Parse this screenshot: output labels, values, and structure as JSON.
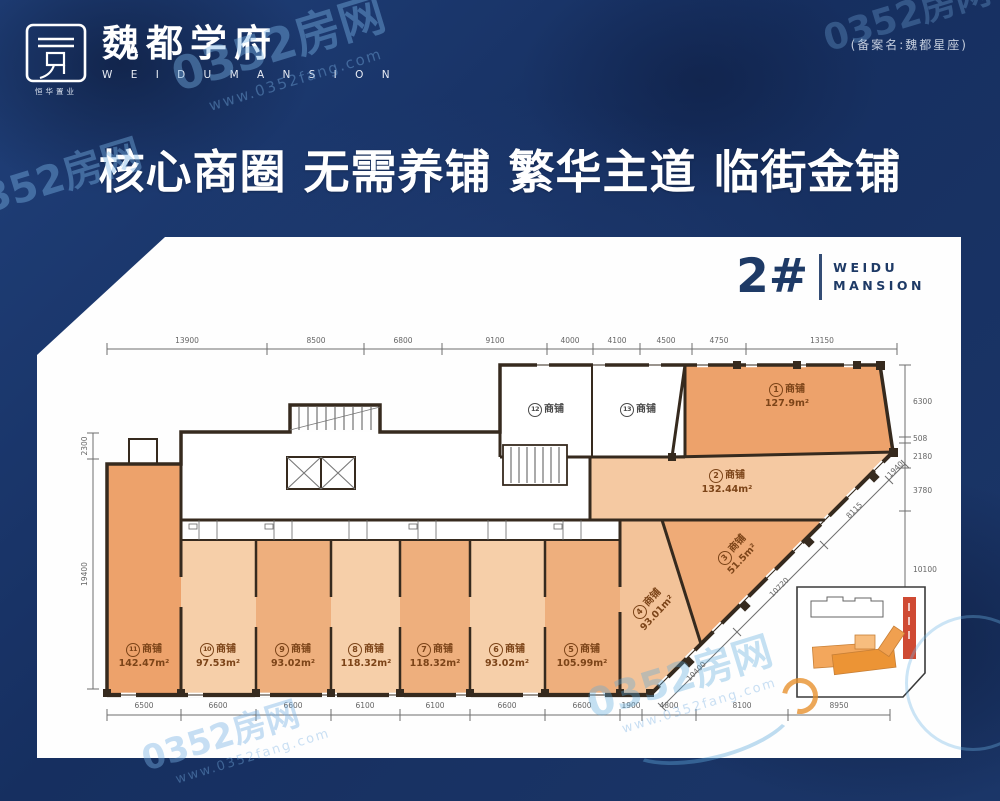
{
  "brand": {
    "logo_cn": "魏都学府",
    "logo_en": "W E I D U   M A N S I O N",
    "logo_sub": "恒华置业",
    "filing": "(备案名:魏都星座)"
  },
  "headline": "核心商圈 无需养铺 繁华主道 临街金铺",
  "plan_header": {
    "number": "2#",
    "en_line1": "WEIDU",
    "en_line2": "MANSION"
  },
  "shops": [
    {
      "num": "1",
      "name": "商铺",
      "area": "127.9m²"
    },
    {
      "num": "2",
      "name": "商铺",
      "area": "132.44m²"
    },
    {
      "num": "3",
      "name": "商铺",
      "area": "51.5m²"
    },
    {
      "num": "4",
      "name": "商铺",
      "area": "93.01m²"
    },
    {
      "num": "5",
      "name": "商铺",
      "area": "105.99m²"
    },
    {
      "num": "6",
      "name": "商铺",
      "area": "93.02m²"
    },
    {
      "num": "7",
      "name": "商铺",
      "area": "118.32m²"
    },
    {
      "num": "8",
      "name": "商铺",
      "area": "118.32m²"
    },
    {
      "num": "9",
      "name": "商铺",
      "area": "93.02m²"
    },
    {
      "num": "10",
      "name": "商铺",
      "area": "97.53m²"
    },
    {
      "num": "11",
      "name": "商铺",
      "area": "142.47m²"
    },
    {
      "num": "12",
      "name": "商铺",
      "area": ""
    },
    {
      "num": "13",
      "name": "商铺",
      "area": ""
    }
  ],
  "dims": {
    "top": [
      "13900",
      "8500",
      "6800",
      "9100",
      "4000",
      "4100",
      "4500",
      "4750",
      "13150"
    ],
    "bottom": [
      "6500",
      "6600",
      "6600",
      "6100",
      "6100",
      "6600",
      "6600",
      "1900",
      "4800",
      "8100",
      "8950"
    ],
    "left": [
      "2300",
      "19400"
    ],
    "right": [
      "6300",
      "508",
      "2180",
      "3780",
      "10100"
    ],
    "diagonal": [
      "1940",
      "8115",
      "10720",
      "10400"
    ]
  },
  "watermark": {
    "text": "0352房网",
    "url": "www.0352fang.com"
  },
  "colors": {
    "background_navy": "#1b3668",
    "accent_navy": "#1e3a66",
    "shop_dark": "#eda26b",
    "shop_mid": "#eeaf7d",
    "shop_light": "#f6cfa9",
    "wall": "#362a1e"
  }
}
